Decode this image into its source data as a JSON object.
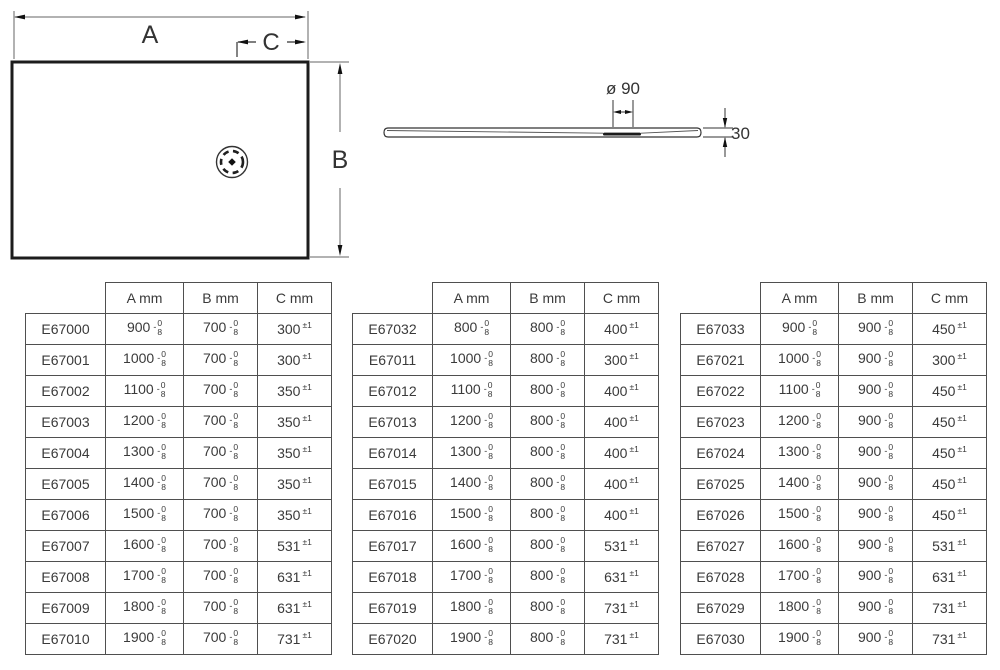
{
  "plan_view": {
    "width_label": "A",
    "depth_label": "B",
    "drain_offset_label": "C"
  },
  "profile_view": {
    "drain_diameter_label": "ø 90",
    "thickness_label": "30"
  },
  "tolerances": {
    "length_sign": "-",
    "length_upper": "0",
    "length_lower": "8",
    "position": "±1"
  },
  "colors": {
    "line_dark": "#1c1c1c",
    "line_mid": "#333333",
    "dim_line": "#666666",
    "table_border": "#4f4f4f",
    "text": "#3a3a3a"
  },
  "tables": [
    {
      "headers": [
        "A mm",
        "B mm",
        "C mm"
      ],
      "rows": [
        {
          "code": "E67000",
          "a": "900",
          "b": "700",
          "c": "300"
        },
        {
          "code": "E67001",
          "a": "1000",
          "b": "700",
          "c": "300"
        },
        {
          "code": "E67002",
          "a": "1100",
          "b": "700",
          "c": "350"
        },
        {
          "code": "E67003",
          "a": "1200",
          "b": "700",
          "c": "350"
        },
        {
          "code": "E67004",
          "a": "1300",
          "b": "700",
          "c": "350"
        },
        {
          "code": "E67005",
          "a": "1400",
          "b": "700",
          "c": "350"
        },
        {
          "code": "E67006",
          "a": "1500",
          "b": "700",
          "c": "350"
        },
        {
          "code": "E67007",
          "a": "1600",
          "b": "700",
          "c": "531"
        },
        {
          "code": "E67008",
          "a": "1700",
          "b": "700",
          "c": "631"
        },
        {
          "code": "E67009",
          "a": "1800",
          "b": "700",
          "c": "631"
        },
        {
          "code": "E67010",
          "a": "1900",
          "b": "700",
          "c": "731"
        }
      ]
    },
    {
      "headers": [
        "A mm",
        "B mm",
        "C mm"
      ],
      "rows": [
        {
          "code": "E67032",
          "a": "800",
          "b": "800",
          "c": "400"
        },
        {
          "code": "E67011",
          "a": "1000",
          "b": "800",
          "c": "300"
        },
        {
          "code": "E67012",
          "a": "1100",
          "b": "800",
          "c": "400"
        },
        {
          "code": "E67013",
          "a": "1200",
          "b": "800",
          "c": "400"
        },
        {
          "code": "E67014",
          "a": "1300",
          "b": "800",
          "c": "400"
        },
        {
          "code": "E67015",
          "a": "1400",
          "b": "800",
          "c": "400"
        },
        {
          "code": "E67016",
          "a": "1500",
          "b": "800",
          "c": "400"
        },
        {
          "code": "E67017",
          "a": "1600",
          "b": "800",
          "c": "531"
        },
        {
          "code": "E67018",
          "a": "1700",
          "b": "800",
          "c": "631"
        },
        {
          "code": "E67019",
          "a": "1800",
          "b": "800",
          "c": "731"
        },
        {
          "code": "E67020",
          "a": "1900",
          "b": "800",
          "c": "731"
        }
      ]
    },
    {
      "headers": [
        "A mm",
        "B mm",
        "C mm"
      ],
      "rows": [
        {
          "code": "E67033",
          "a": "900",
          "b": "900",
          "c": "450"
        },
        {
          "code": "E67021",
          "a": "1000",
          "b": "900",
          "c": "300"
        },
        {
          "code": "E67022",
          "a": "1100",
          "b": "900",
          "c": "450"
        },
        {
          "code": "E67023",
          "a": "1200",
          "b": "900",
          "c": "450"
        },
        {
          "code": "E67024",
          "a": "1300",
          "b": "900",
          "c": "450"
        },
        {
          "code": "E67025",
          "a": "1400",
          "b": "900",
          "c": "450"
        },
        {
          "code": "E67026",
          "a": "1500",
          "b": "900",
          "c": "450"
        },
        {
          "code": "E67027",
          "a": "1600",
          "b": "900",
          "c": "531"
        },
        {
          "code": "E67028",
          "a": "1700",
          "b": "900",
          "c": "631"
        },
        {
          "code": "E67029",
          "a": "1800",
          "b": "900",
          "c": "731"
        },
        {
          "code": "E67030",
          "a": "1900",
          "b": "900",
          "c": "731"
        }
      ]
    }
  ]
}
